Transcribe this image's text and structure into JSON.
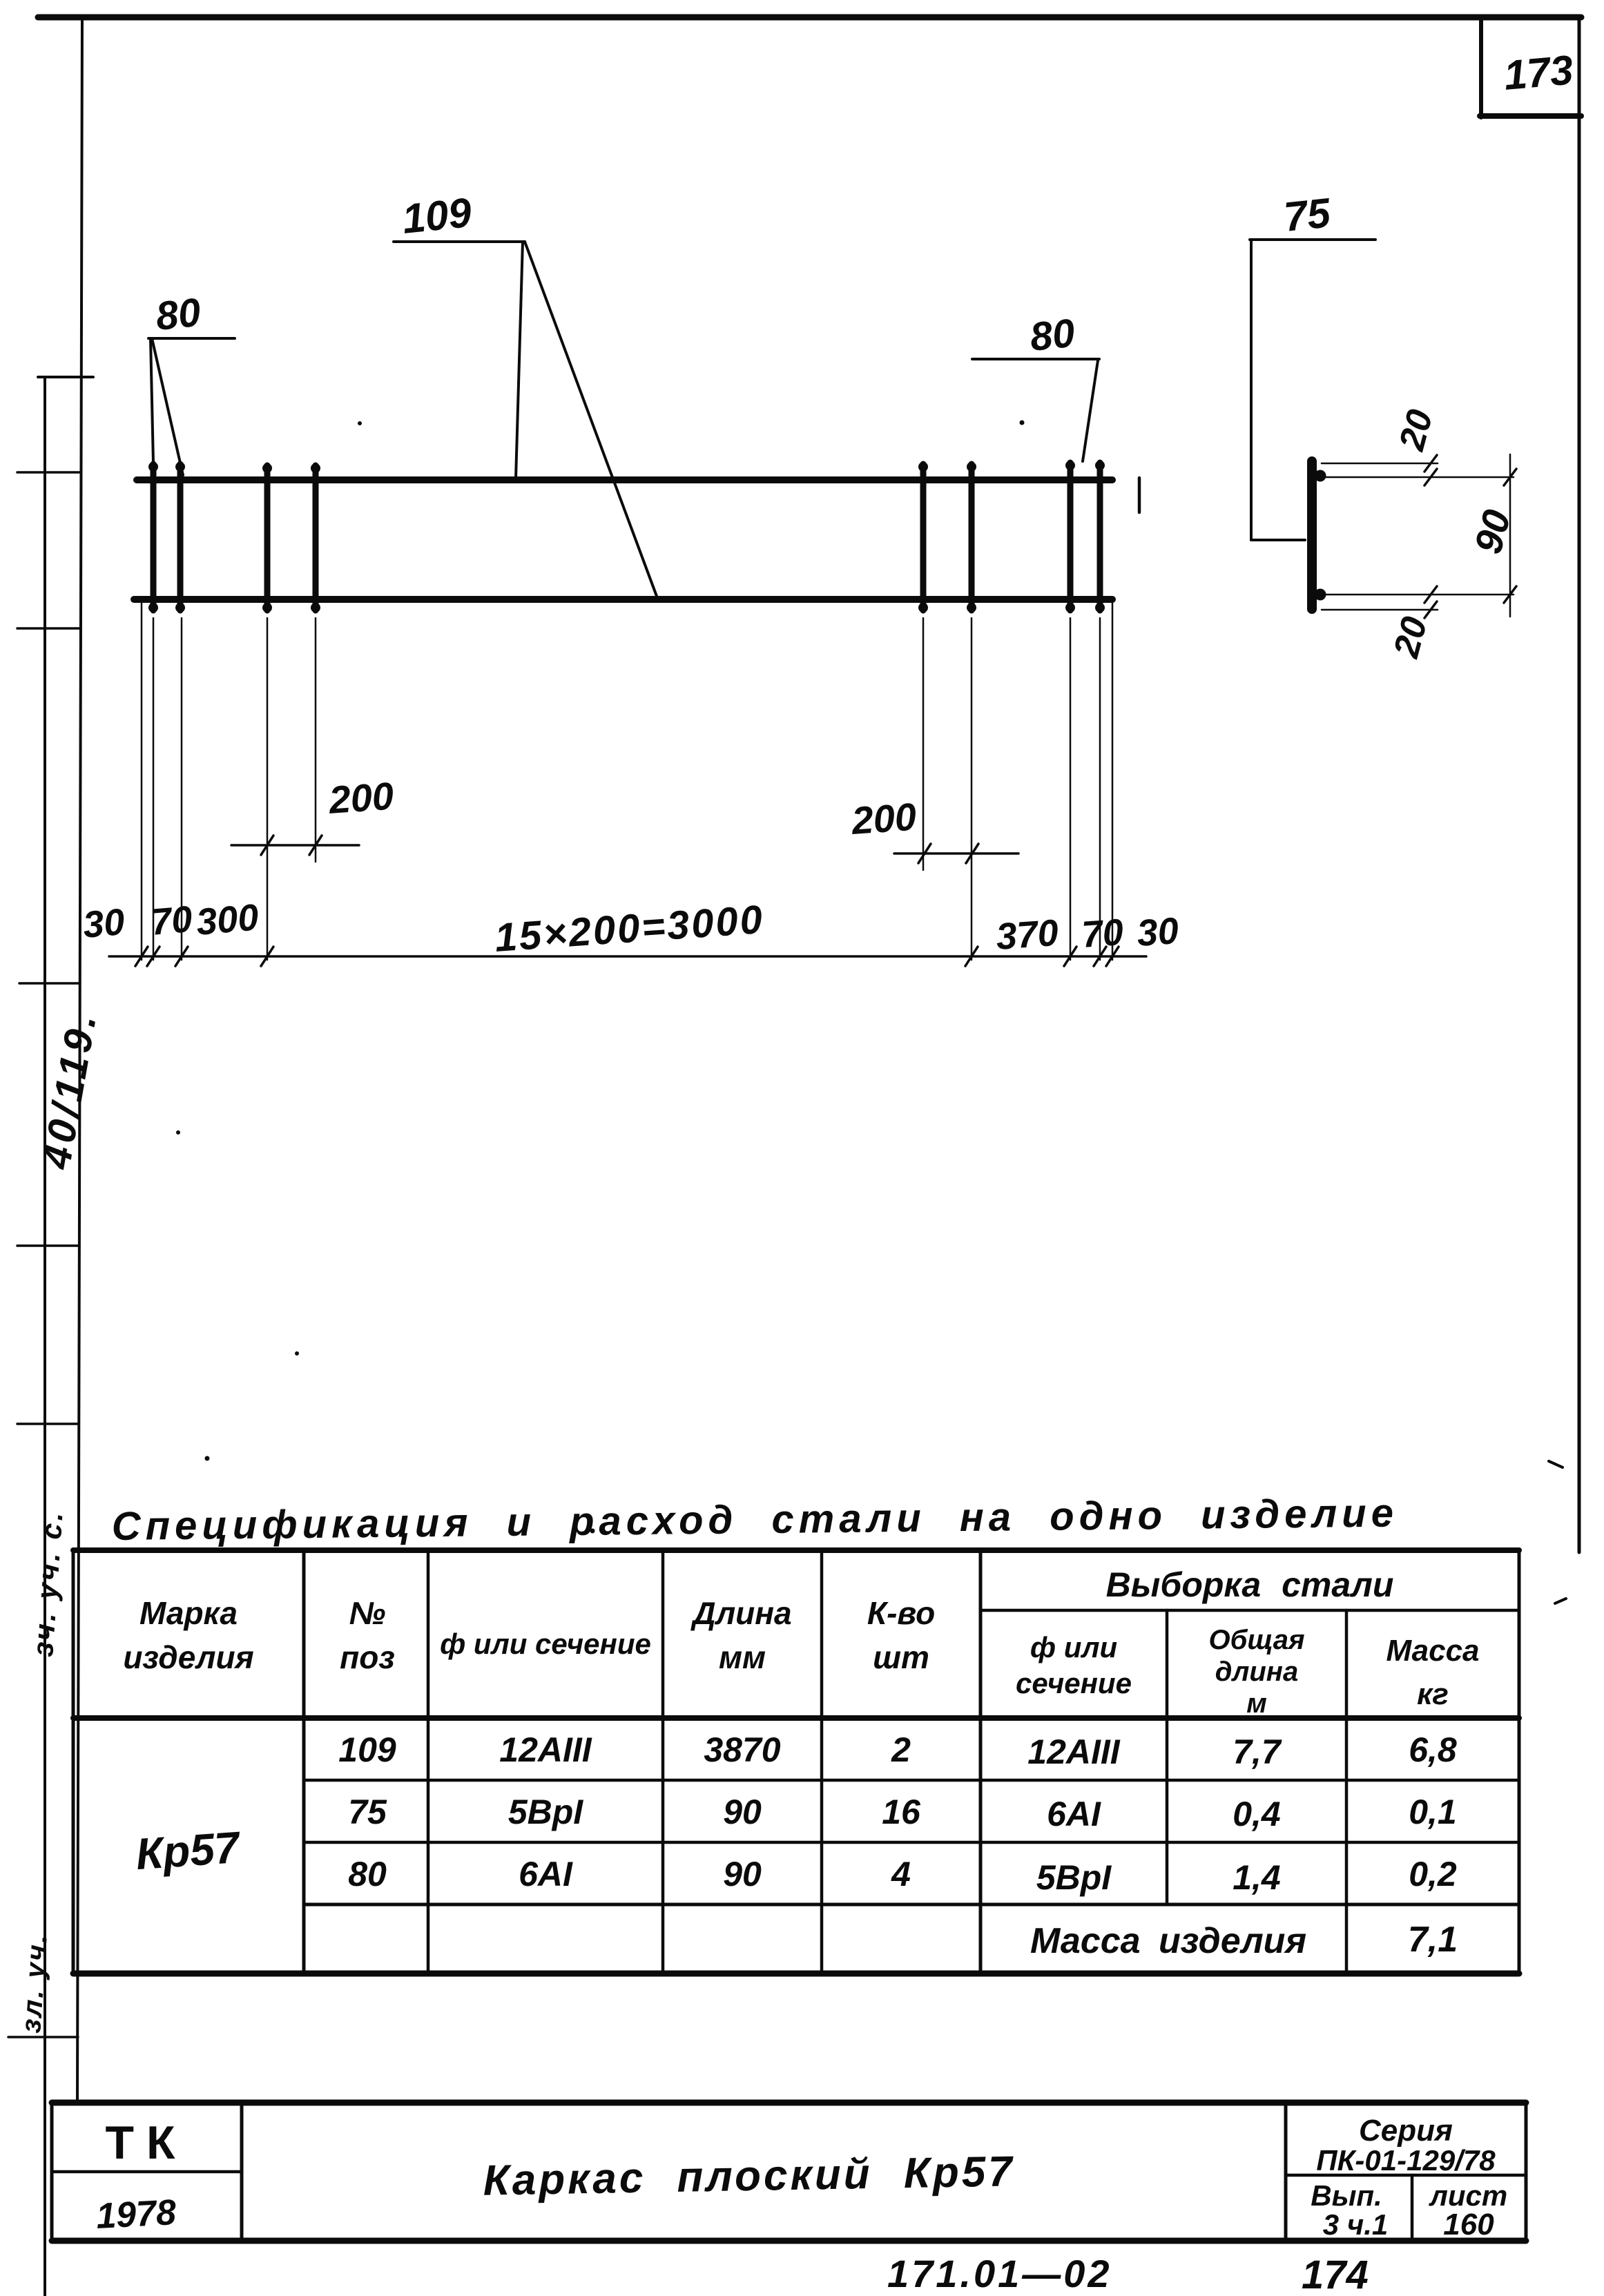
{
  "page": {
    "number": "173",
    "footer_left": "171.01—02",
    "footer_right": "174"
  },
  "margin": {
    "note1": "40/119.",
    "note2": "зч. уч. с.",
    "note3": "зл. уч."
  },
  "drawing": {
    "pos109": "109",
    "pos80_left": "80",
    "pos80_right": "80",
    "pos75": "75",
    "dims": {
      "d200_left": "200",
      "d200_right": "200",
      "d30_left": "30",
      "d70_left": "70",
      "d300": "300",
      "series": "15×200=3000",
      "d370": "370",
      "d70_right": "70",
      "d30_right": "30",
      "d20_top": "20",
      "d90": "90",
      "d20_bottom": "20"
    }
  },
  "table": {
    "title": "Спецификация и расход стали на одно изделие",
    "headers": {
      "marka1": "Марка",
      "marka2": "изделия",
      "pos1": "№",
      "pos2": "поз",
      "section": "ф или сечение",
      "len1": "Длина",
      "len2": "мм",
      "qty1": "К-во",
      "qty2": "шт",
      "group": "Выборка стали",
      "gsec1": "ф или",
      "gsec2": "сечение",
      "glen1": "Общая",
      "glen2": "длина",
      "glen3": "м",
      "gmass1": "Масса",
      "gmass2": "кг"
    },
    "mark": "Кр57",
    "rows": [
      {
        "pos": "109",
        "section": "12АIII",
        "length": "3870",
        "qty": "2",
        "g_section": "12АIII",
        "g_length": "7,7",
        "g_mass": "6,8"
      },
      {
        "pos": "75",
        "section": "5ВрI",
        "length": "90",
        "qty": "16",
        "g_section": "6АI",
        "g_length": "0,4",
        "g_mass": "0,1"
      },
      {
        "pos": "80",
        "section": "6АI",
        "length": "90",
        "qty": "4",
        "g_section": "5ВрI",
        "g_length": "1,4",
        "g_mass": "0,2"
      }
    ],
    "total_label": "Масса изделия",
    "total_value": "7,1"
  },
  "titleblock": {
    "org": "ТК",
    "year": "1978",
    "title": "Каркас плоский Кр57",
    "series_label": "Серия",
    "series_value": "ПК-01-129/78",
    "issue_label": "Вып.",
    "issue_value": "3 ч.1",
    "sheet_label": "лист",
    "sheet_value": "160"
  }
}
